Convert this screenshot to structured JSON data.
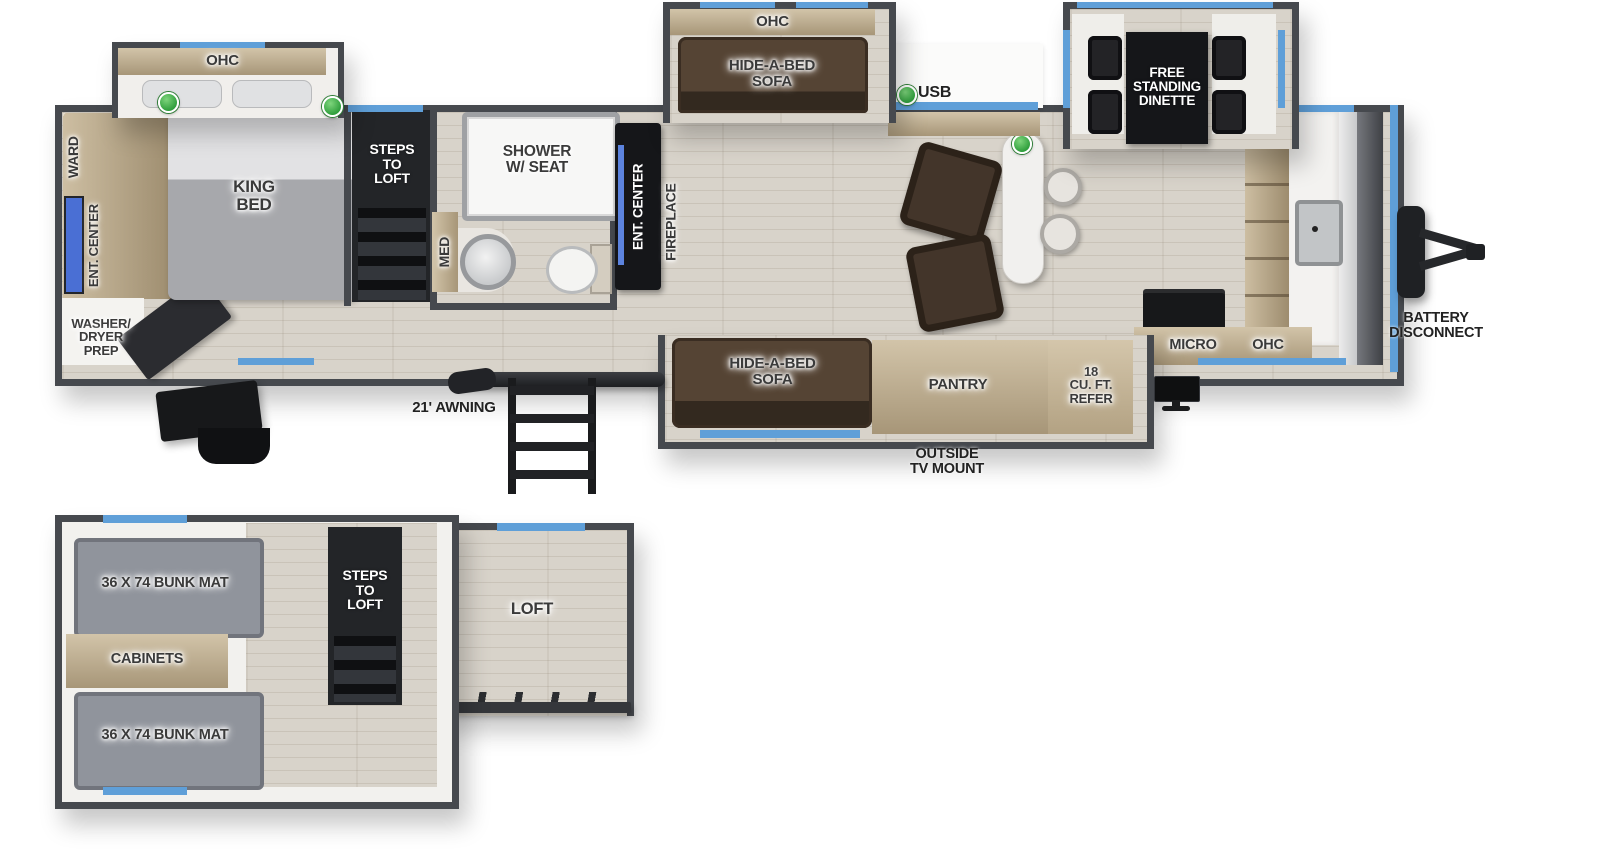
{
  "colors": {
    "wall": "#46494e",
    "floor_wood": "#d8d3ca",
    "cabinet_tan": "#bfae92",
    "sofa_brown": "#47382b",
    "black_unit": "#151619",
    "window_blue": "#5f9fd8",
    "led_green": "#3cae47",
    "mattress_gray": "#a7a8ac",
    "bunk_gray": "#8f939b",
    "island_white": "#f1f0ee"
  },
  "main": {
    "bedroom_slide": {
      "ohc_label": "OHC"
    },
    "bedroom": {
      "king_bed_label": "KING\nBED",
      "ward_label": "WARD",
      "ent_center_label": "ENT. CENTER",
      "washer_dryer_label": "WASHER/\nDRYER\nPREP"
    },
    "steps_label": "STEPS\nTO\nLOFT",
    "bathroom": {
      "shower_label": "SHOWER\nW/ SEAT",
      "med_label": "MED"
    },
    "fireplace_unit": {
      "ent_center_label": "ENT. CENTER",
      "fireplace_label": "FIREPLACE"
    },
    "sofa_slide": {
      "ohc_label": "OHC",
      "sofa_label": "HIDE-A-BED\nSOFA"
    },
    "usb_label": "USB",
    "dinette_slide": {
      "dinette_label": "FREE\nSTANDING\nDINETTE"
    },
    "kitchen": {
      "micro_label": "MICRO",
      "ohc_label": "OHC"
    },
    "bottom_slide": {
      "sofa_label": "HIDE-A-BED\nSOFA",
      "pantry_label": "PANTRY",
      "refer_label": "18\nCU. FT.\nREFER"
    },
    "exterior": {
      "awning_label": "21' AWNING",
      "outside_tv_label": "OUTSIDE\nTV MOUNT",
      "battery_label": "BATTERY\nDISCONNECT"
    }
  },
  "loft": {
    "bunk_top_label": "36 X 74 BUNK MAT",
    "cabinets_label": "CABINETS",
    "bunk_bottom_label": "36 X 74 BUNK MAT",
    "steps_label": "STEPS\nTO\nLOFT",
    "loft_label": "LOFT"
  }
}
